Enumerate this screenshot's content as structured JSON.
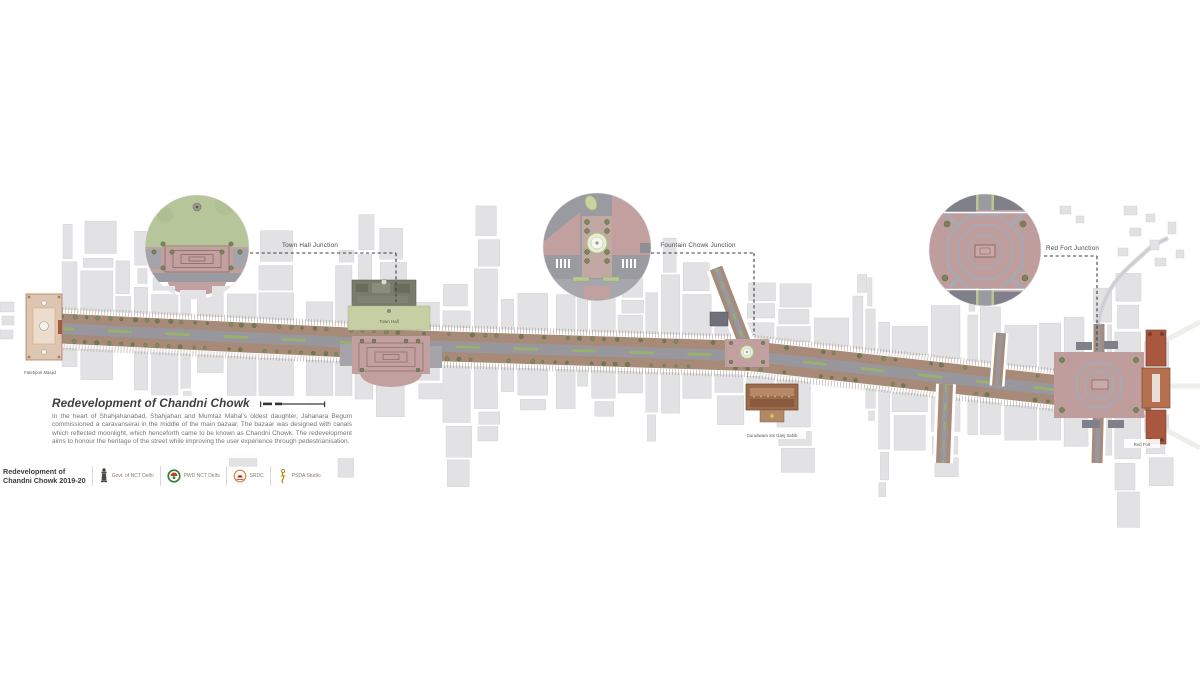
{
  "colors": {
    "canvas": "#ffffff",
    "fabric": "#e2e2e4",
    "fabric_stroke": "#cdcdd1",
    "footpath_tan": "#a78a77",
    "road_gray": "#97979d",
    "median_green": "#9cb06b",
    "plaza_pink": "#c2a0a0",
    "plaza_line": "#8d6a6a",
    "lawn_green": "#b7c59b",
    "tree_green": "#76865a",
    "tree_ring": "#4e5a39",
    "tick_brown": "#80695a",
    "leader_dark": "#3f3f3f",
    "fort_red": "#a9573f"
  },
  "map": {
    "callouts": [
      {
        "label": "Town Hall Junction"
      },
      {
        "label": "Fountain Chowk Junction"
      },
      {
        "label": "Red Fort Junction"
      }
    ],
    "landmarks": [
      {
        "label": "Fatehpuri Masjid"
      },
      {
        "label": "Town Hall"
      },
      {
        "label": "Gurudwara Sis Ganj Sahib"
      },
      {
        "label": "Red Fort"
      }
    ]
  },
  "title_block": {
    "title": "Redevelopment of Chandni Chowk",
    "description": "In the heart of Shahjahanabad, Shahjahan and Mumtaz Mahal's oldest daughter, Jahanara Begum commissioned a caravanserai in the middle of the main bazaar. The bazaar was designed with canals which reflected moonlight, which henceforth came to be known as Chandni Chowk. The redevelopment aims to honour the heritage of the street while improving the user experience through pedestrianisation."
  },
  "footer": {
    "project_line1": "Redevelopment of",
    "project_line2": "Chandni Chowk 2019-20",
    "logos": [
      {
        "name": "govt-nct-delhi",
        "label": "Govt. of NCT Delhi"
      },
      {
        "name": "pwd-nct-delhi",
        "label": "PWD NCT Delhi"
      },
      {
        "name": "srdc",
        "label": "SRDC"
      },
      {
        "name": "psda-studio",
        "label": "PSDA Studio"
      }
    ]
  }
}
